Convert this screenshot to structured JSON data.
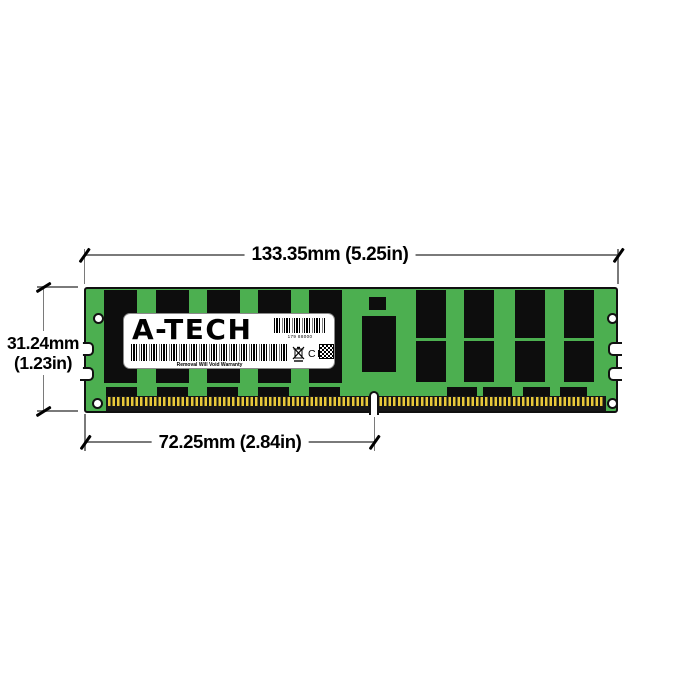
{
  "annotations": {
    "width": "133.35mm (5.25in)",
    "height_mm": "31.24mm",
    "height_in": "(1.23in)",
    "pin_notch": "72.25mm (2.84in)"
  },
  "module": {
    "brand": "A-TECH",
    "label": {
      "serial": "179 88000",
      "warranty": "Removal Will Void Warranty",
      "ce": "CE"
    },
    "colors": {
      "pcb": "#4caf50",
      "chips": "#0d0d0d",
      "pins_gold": "#e8c93a",
      "label_bg": "#ffffff",
      "dimension_lines": "#7a7a7a"
    }
  }
}
